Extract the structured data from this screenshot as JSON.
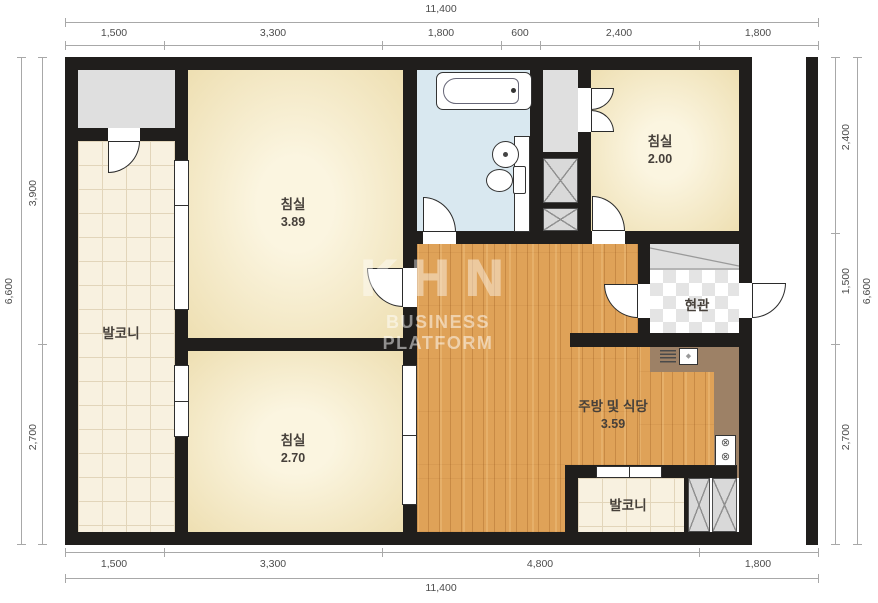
{
  "dimensions": {
    "top": {
      "total": "11,400",
      "segments": [
        "1,500",
        "3,300",
        "1,800",
        "600",
        "2,400",
        "1,800"
      ]
    },
    "bottom": {
      "total": "11,400",
      "segments": [
        "1,500",
        "3,300",
        "4,800",
        "1,800"
      ]
    },
    "left": {
      "total": "6,600",
      "segments": [
        "3,900",
        "2,700"
      ]
    },
    "right": {
      "total": "6,600",
      "segments": [
        "2,400",
        "1,500",
        "2,700"
      ]
    }
  },
  "rooms": {
    "bedroom_main": {
      "name": "침실",
      "area": "3.89"
    },
    "bedroom_upper_right": {
      "name": "침실",
      "area": "2.00"
    },
    "bedroom_lower_left": {
      "name": "침실",
      "area": "2.70"
    },
    "kitchen_dining": {
      "name": "주방 및 식당",
      "area": "3.59"
    },
    "entrance": {
      "name": "현관"
    },
    "balcony_left": {
      "name": "발코니"
    },
    "balcony_bottom": {
      "name": "발코니"
    }
  },
  "watermark": {
    "logo": "KHN",
    "tagline": "BUSINESS PLATFORM"
  },
  "icons": {
    "kitchen_sink": "◆",
    "stove_burner": "⊗"
  },
  "colors": {
    "wall": "#201e1c",
    "wood_floor": "#dfa258",
    "bedroom_floor": "#f6ecc9",
    "balcony_tile": "#f8f1e0",
    "bathroom": "#d9e8f0",
    "counter": "#9d8166",
    "shaft": "#d9d9d9",
    "dimension_text": "#4c4c4c"
  }
}
